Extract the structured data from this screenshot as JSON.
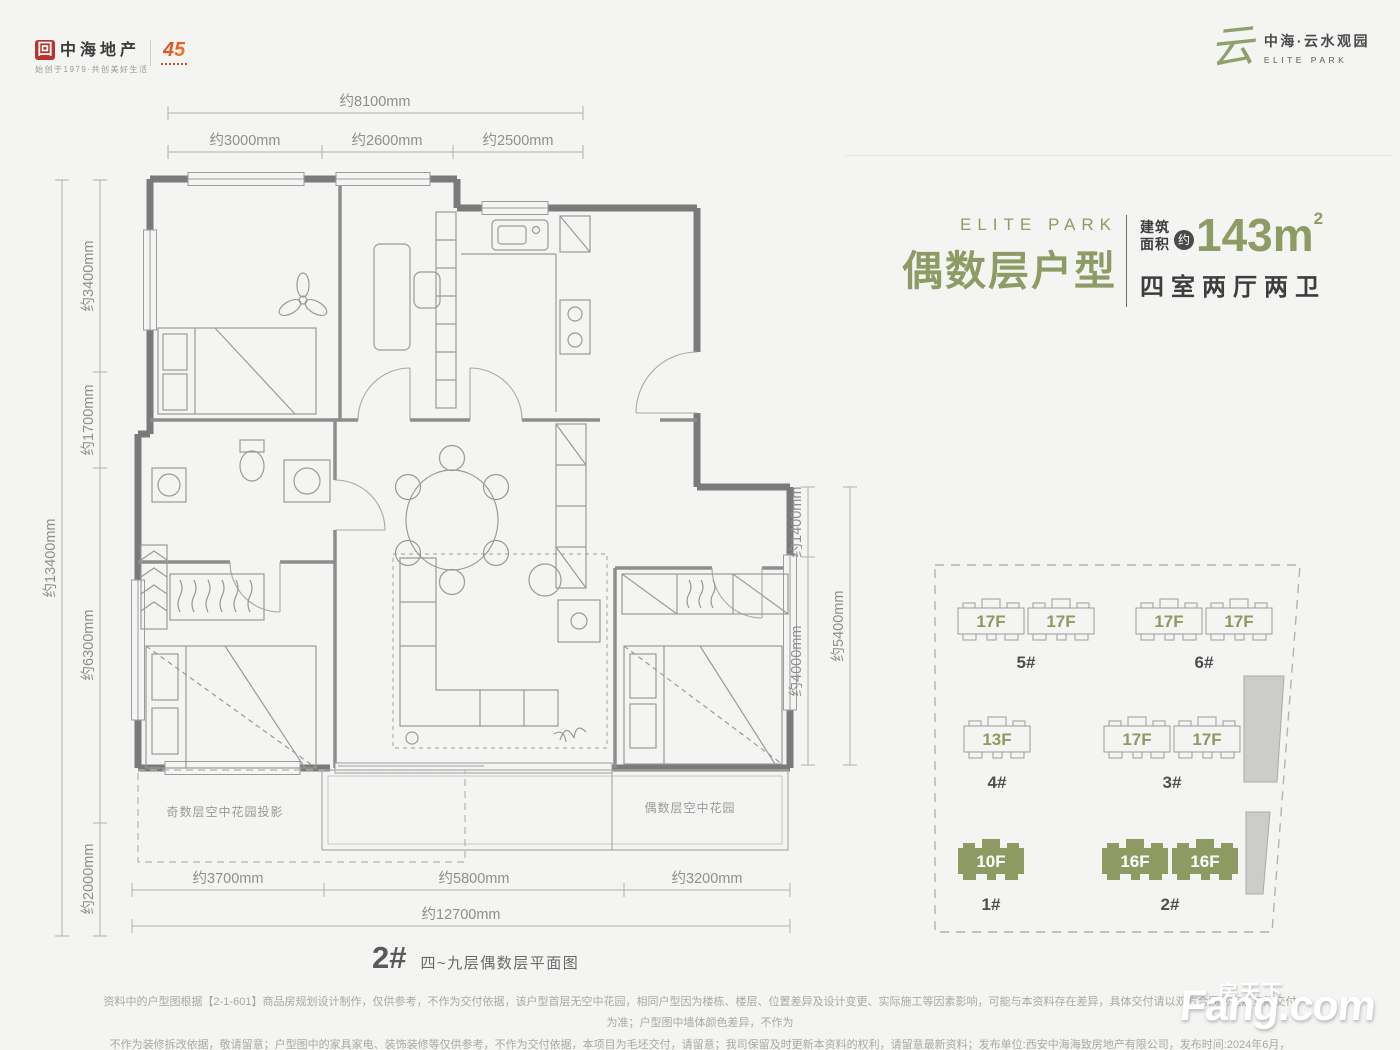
{
  "header": {
    "logo_mark_glyph": "回",
    "logo_cn": "中海地产",
    "logo_tagline": "始创于1979·共创美好生活",
    "anniversary": "45",
    "project_glyph": "云",
    "project_name": "中海·云水观园",
    "project_name_en": "ELITE PARK"
  },
  "title_block": {
    "brand_en": "ELITE PARK",
    "title": "偶数层户型",
    "area_label_line1": "建筑",
    "area_label_line2": "面积",
    "approx_badge": "约",
    "area_value": "143m",
    "area_sup": "2",
    "layout": "四室两厅两卫"
  },
  "plan": {
    "dims": {
      "top_overall": "约8100mm",
      "top_segments": [
        "约3000mm",
        "约2600mm",
        "约2500mm"
      ],
      "left_overall": "约13400mm",
      "left_segments": [
        "约3400mm",
        "约1700mm",
        "约6300mm",
        "约2000mm"
      ],
      "right_segments": [
        "约1400mm",
        "约4000mm"
      ],
      "right_overall": "约5400mm",
      "bottom_segments": [
        "约3700mm",
        "约5800mm",
        "约3200mm"
      ],
      "bottom_overall": "约12700mm"
    },
    "labels": {
      "odd_garden": "奇数层空中花园投影",
      "even_garden": "偶数层空中花园"
    }
  },
  "site_plan": {
    "buildings": [
      {
        "id": "5#",
        "floors": [
          "17F",
          "17F"
        ],
        "highlight": false
      },
      {
        "id": "6#",
        "floors": [
          "17F",
          "17F"
        ],
        "highlight": false
      },
      {
        "id": "4#",
        "floors": [
          "13F"
        ],
        "highlight": false
      },
      {
        "id": "3#",
        "floors": [
          "17F",
          "17F"
        ],
        "highlight": false
      },
      {
        "id": "1#",
        "floors": [
          "10F"
        ],
        "highlight": true
      },
      {
        "id": "2#",
        "floors": [
          "16F",
          "16F"
        ],
        "highlight": true
      }
    ]
  },
  "footer": {
    "plan_number": "2#",
    "plan_caption": "四~九层偶数层平面图",
    "disclaimer_line1": "资料中的户型图根据【2-1-601】商品房规划设计制作，仅供参考，不作为交付依据，该户型首层无空中花园，相同户型因为楼栋、楼层、位置差异及设计变更、实际施工等因素影响，可能与本资料存在差异，具体交付请以双方合同约定及实际交付为准；户型图中墙体颜色差异，不作为",
    "disclaimer_line2": "不作为装修拆改依据，敬请留意；户型图中的家具家电、装饰装修等仅供参考，不作为交付依据，本项目为毛坯交付，请留意；我司保留及时更新本资料的权利，请留意最新资料；发布单位:西安中海海致房地产有限公司，发布时间:2024年6月，",
    "watermark_cn": "房天下",
    "watermark_en": "Fang.com"
  },
  "colors": {
    "accent_green": "#8e9b64",
    "wall_gray": "#7a7a7a",
    "line_gray": "#a5a5a5",
    "text_dark": "#3d3d3d"
  }
}
